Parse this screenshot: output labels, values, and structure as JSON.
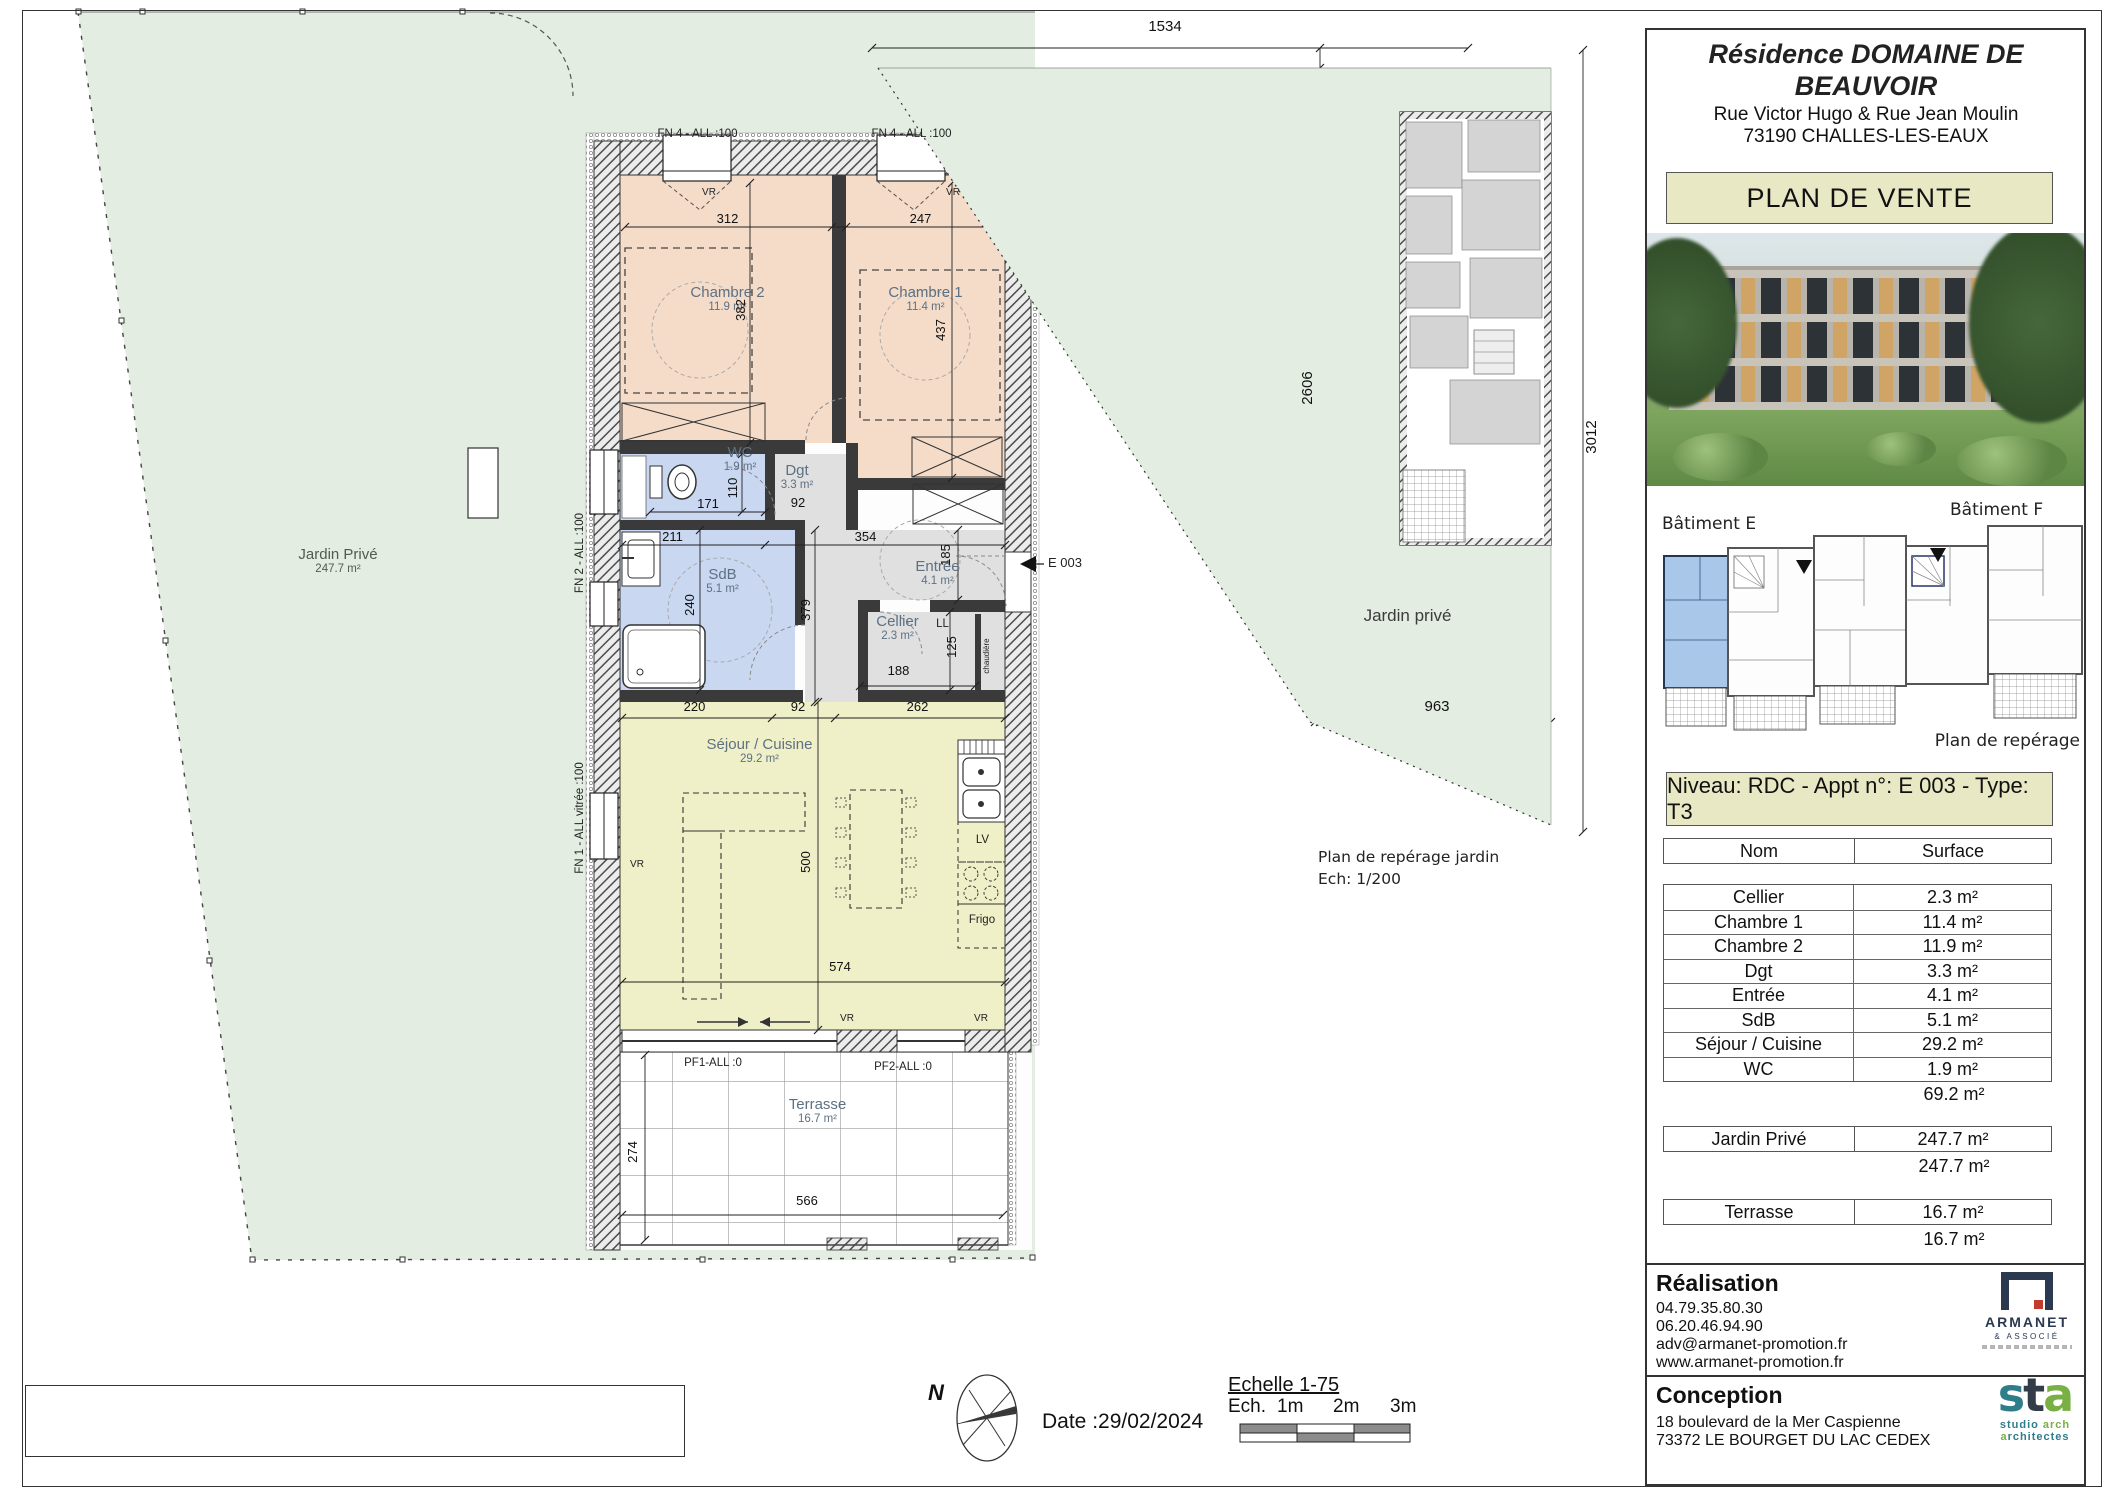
{
  "header": {
    "title": "Résidence DOMAINE DE BEAUVOIR",
    "address_line1": "Rue Victor Hugo & Rue Jean Moulin",
    "address_line2": "73190 CHALLES-LES-EAUX",
    "plan_label": "PLAN DE VENTE"
  },
  "reperage": {
    "batiment_left": "Bâtiment E",
    "batiment_right": "Bâtiment F",
    "caption": "Plan de repérage"
  },
  "unit_banner": "Niveau: RDC - Appt n°: E 003 - Type: T3",
  "surface_table": {
    "col_name": "Nom",
    "col_surface": "Surface",
    "rooms": [
      {
        "name": "Cellier",
        "surface": "2.3 m²"
      },
      {
        "name": "Chambre 1",
        "surface": "11.4 m²"
      },
      {
        "name": "Chambre 2",
        "surface": "11.9 m²"
      },
      {
        "name": "Dgt",
        "surface": "3.3 m²"
      },
      {
        "name": "Entrée",
        "surface": "4.1 m²"
      },
      {
        "name": "SdB",
        "surface": "5.1 m²"
      },
      {
        "name": "Séjour / Cuisine",
        "surface": "29.2 m²"
      },
      {
        "name": "WC",
        "surface": "1.9 m²"
      }
    ],
    "rooms_total": "69.2 m²",
    "jardin_name": "Jardin Privé",
    "jardin_surface": "247.7 m²",
    "jardin_total": "247.7 m²",
    "terrasse_name": "Terrasse",
    "terrasse_surface": "16.7 m²",
    "terrasse_total": "16.7 m²"
  },
  "realisation": {
    "heading": "Réalisation",
    "phone1": "04.79.35.80.30",
    "phone2": "06.20.46.94.90",
    "email": "adv@armanet-promotion.fr",
    "website": "www.armanet-promotion.fr",
    "logo_name": "ARMANET",
    "logo_sub": "& ASSOCIÉ"
  },
  "conception": {
    "heading": "Conception",
    "address_line1": "18 boulevard de la Mer Caspienne",
    "address_line2": "73372 LE BOURGET DU LAC CEDEX",
    "logo_s": "s",
    "logo_t": "t",
    "logo_a": "a",
    "logo_studio": "studio",
    "logo_arch": "arch",
    "logo_archi_a": "a",
    "logo_archi_rest": "rchitectes"
  },
  "plan": {
    "room_labels": {
      "chambre2": {
        "name": "Chambre 2",
        "area": "11.9 m²"
      },
      "chambre1": {
        "name": "Chambre 1",
        "area": "11.4 m²"
      },
      "wc": {
        "name": "WC",
        "area": "1.9 m²"
      },
      "dgt": {
        "name": "Dgt",
        "area": "3.3 m²"
      },
      "sdb": {
        "name": "SdB",
        "area": "5.1 m²"
      },
      "entree": {
        "name": "Entrée",
        "area": "4.1 m²"
      },
      "cellier": {
        "name": "Cellier",
        "area": "2.3 m²"
      },
      "sejour": {
        "name": "Séjour / Cuisine",
        "area": "29.2 m²"
      },
      "terrasse": {
        "name": "Terrasse",
        "area": "16.7 m²"
      },
      "jardin": {
        "name": "Jardin Privé",
        "area": "247.7 m²"
      }
    },
    "entrance_label": "E 003",
    "win": {
      "fn4": "FN 4 - ALL :100",
      "fn2": "FN 2 - ALL :100",
      "fn1": "FN 1 - ALL vitrée :100",
      "pf1": "PF1-ALL :0",
      "pf2": "PF2-ALL :0",
      "vr": "VR",
      "ll": "LL",
      "lv": "LV",
      "frigo": "Frigo",
      "chaudiere": "chaudière"
    },
    "dims": {
      "chambre2_w": "312",
      "chambre1_w": "247",
      "chambre2_h": "382",
      "chambre1_h": "437",
      "wc_h": "110",
      "wc_w": "171",
      "sdb_w": "211",
      "dgt_w": "92",
      "entree_w": "354",
      "entree_h": "185",
      "sdb_h": "240",
      "hall_h": "379",
      "cellier_w": "188",
      "cellier_h": "125",
      "sejour_a": "220",
      "sejour_b": "92",
      "sejour_c": "262",
      "sejour_h": "500",
      "sejour_w": "574",
      "terrasse_h": "274",
      "terrasse_w": "566"
    },
    "jardin_plan": {
      "label": "Jardin privé",
      "dim_top": "1534",
      "dim_left": "2606",
      "dim_right": "3012",
      "dim_bottom": "963",
      "caption_line1": "Plan de repérage jardin",
      "caption_line2": "Ech: 1/200"
    }
  },
  "footer": {
    "disclaimer_lines": [
      "-Les surfaces et les cotes peuvent varier de plus ou moins 5%. Des modifications peuvent éventuellement être apportées à ce plan",
      "en fonction des nécessités techniques ou architecturales de réalisation, tant pour les dimensions que pour les équipements.",
      "-Les retombées en plafond (poutres, caissons, soffites, faux-plafonds) ne sont pas représentées.",
      "-Les canalisations et radiateurs ne sont pas représentés. Les indications d'équipements et de plantation ne sont pas contractuelles."
    ],
    "north_label": "N",
    "date_label": "Date :29/02/2024",
    "scale_title": "Echelle 1-75",
    "scale_prefix": "Ech.",
    "scale_tick1": "1m",
    "scale_tick2": "2m",
    "scale_tick3": "3m"
  },
  "colors": {
    "garden": "#e3ede1",
    "bedroom": "#f4dcc9",
    "bathroom": "#c9d7f0",
    "living": "#efefc8",
    "circulation": "#e0e0e0",
    "accent_khaki": "#e8e8c4",
    "room_label": "#5d7184",
    "armanet_navy": "#2b3950",
    "armanet_red": "#c43b2e",
    "sta_teal": "#2e7d8a",
    "sta_green": "#79b043"
  }
}
